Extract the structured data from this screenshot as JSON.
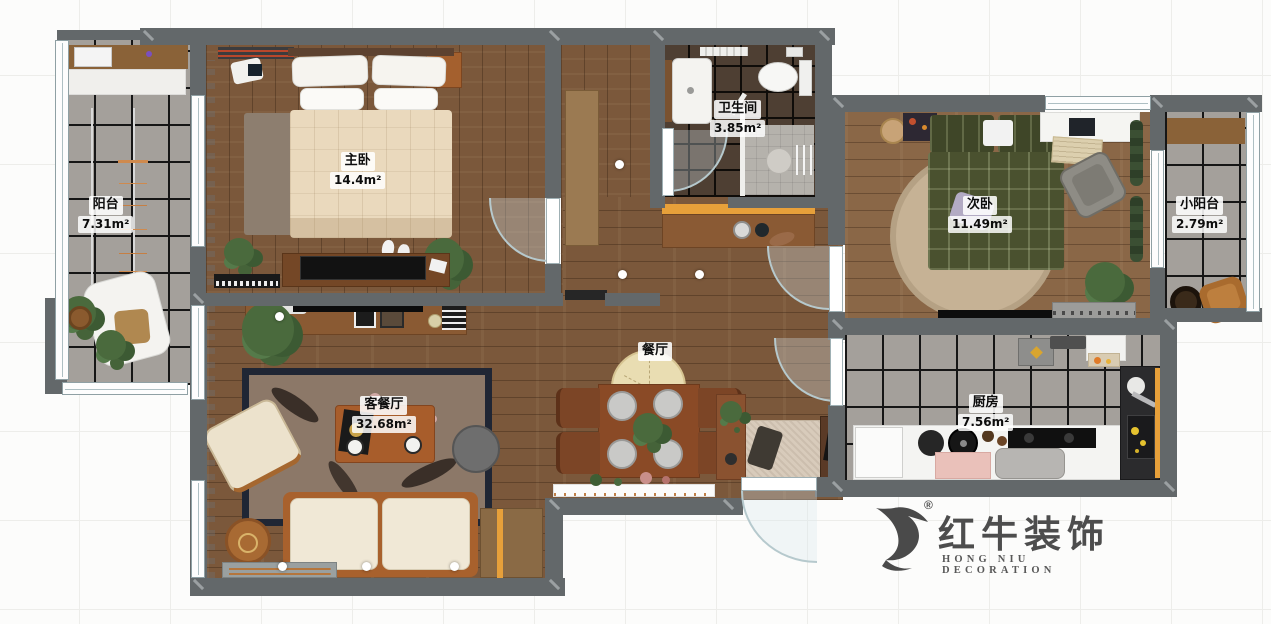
{
  "rooms": [
    {
      "name": "阳台",
      "area": "7.31m²"
    },
    {
      "name": "主卧",
      "area": "14.4m²"
    },
    {
      "name": "卫生间",
      "area": "3.85m²"
    },
    {
      "name": "次卧",
      "area": "11.49m²"
    },
    {
      "name": "小阳台",
      "area": "2.79m²"
    },
    {
      "name": "餐厅",
      "area": ""
    },
    {
      "name": "客餐厅",
      "area": "32.68m²"
    },
    {
      "name": "厨房",
      "area": "7.56m²"
    }
  ],
  "logo": {
    "mark": "®",
    "name_cn": "红牛装饰",
    "name_en": "HONG NIU DECORATION"
  },
  "colors": {
    "wall": "#63686a",
    "wood": "#7b583b",
    "tile": "#a4a09b",
    "tiledark": "#4e3f33",
    "accent": "#e7a03a"
  }
}
